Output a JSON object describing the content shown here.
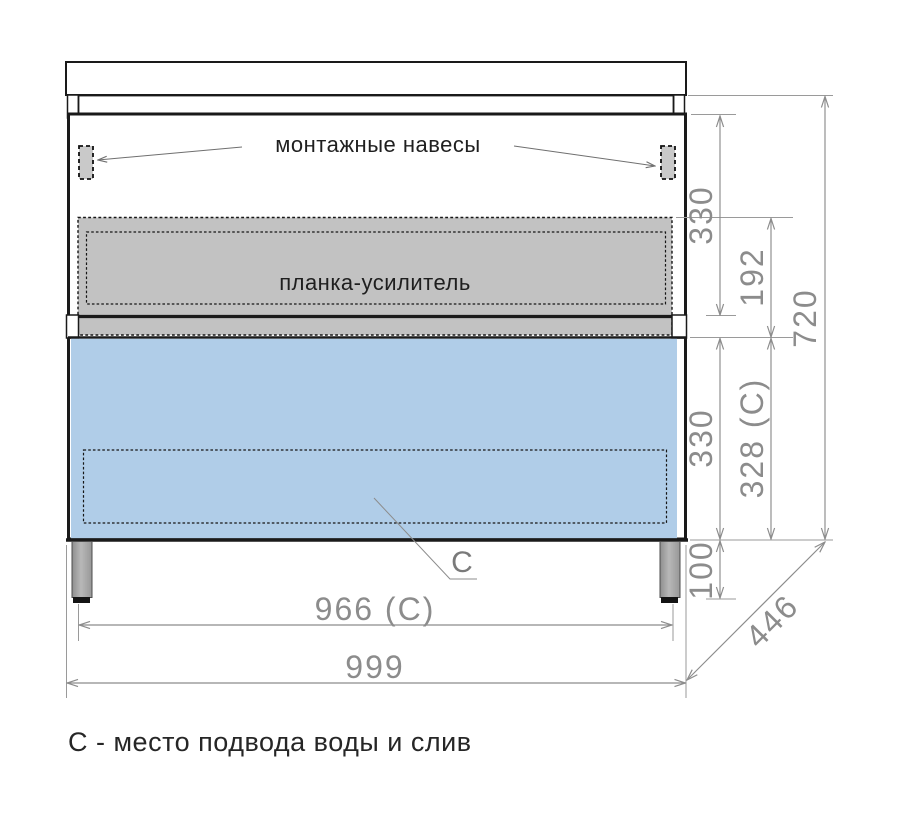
{
  "diagram": {
    "labels": {
      "mounting_hangers": "монтажные навесы",
      "reinforcement_bar": "планка-усилитель",
      "connection_marker": "C"
    },
    "dimensions": {
      "upper_section_height": "330",
      "reinforcement_offset": "192",
      "total_height": "720",
      "drawer_section_height": "330",
      "drawer_section_height_c": "328 (C)",
      "leg_height": "100",
      "depth": "446",
      "connection_width": "966 (C)",
      "overall_width": "999"
    },
    "footnote": "С - место подвода воды и слив",
    "colors": {
      "drawer_fill": "#b0cde8",
      "reinforcement_fill": "#c2c2c2",
      "bracket_fill": "#c9c9c9",
      "outline": "#1a1a1a",
      "dimension": "#8c8c8c"
    }
  }
}
